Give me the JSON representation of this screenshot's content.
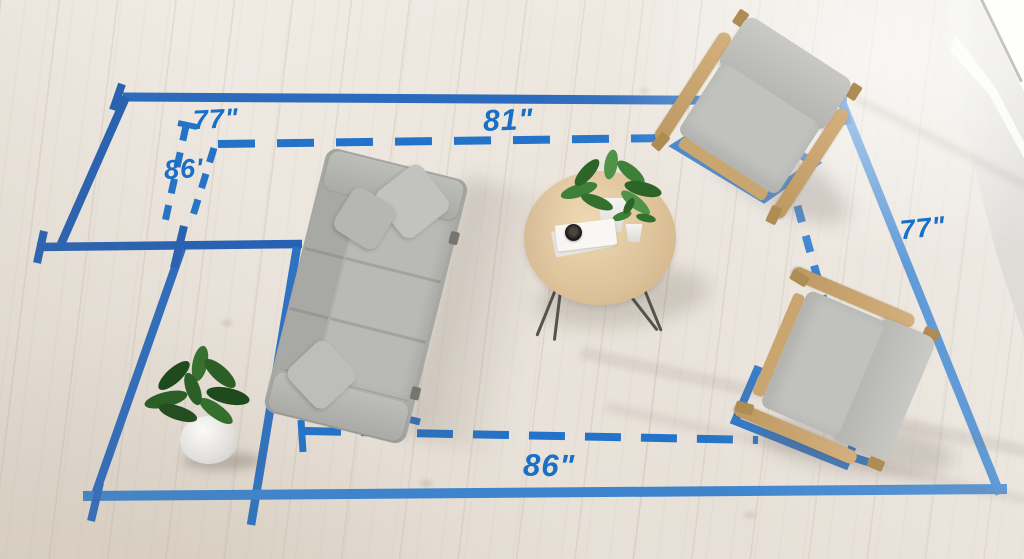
{
  "scene": {
    "description": "Top-down living room photo with blue tape measurement overlay",
    "objects": [
      "sofa",
      "coffee-table",
      "armchair-top-right",
      "armchair-bottom-right",
      "floor-plant",
      "table-plants",
      "window"
    ]
  },
  "measurements": {
    "top_left": "77\"",
    "left": "86'",
    "top_center": "81\"",
    "right": "77\"",
    "bottom": "86\""
  },
  "colors": {
    "tape_solid": "#2c6cbe",
    "tape_light": "#4a8ed2",
    "tape_dashed": "#2273c9",
    "label_text": "#1a6fc7",
    "floor": "#eae4dc",
    "sofa_gray": "#b2b3af",
    "chair_wood": "#cda672",
    "table_wood": "#dec29a",
    "plant_green": "#3c7034"
  }
}
